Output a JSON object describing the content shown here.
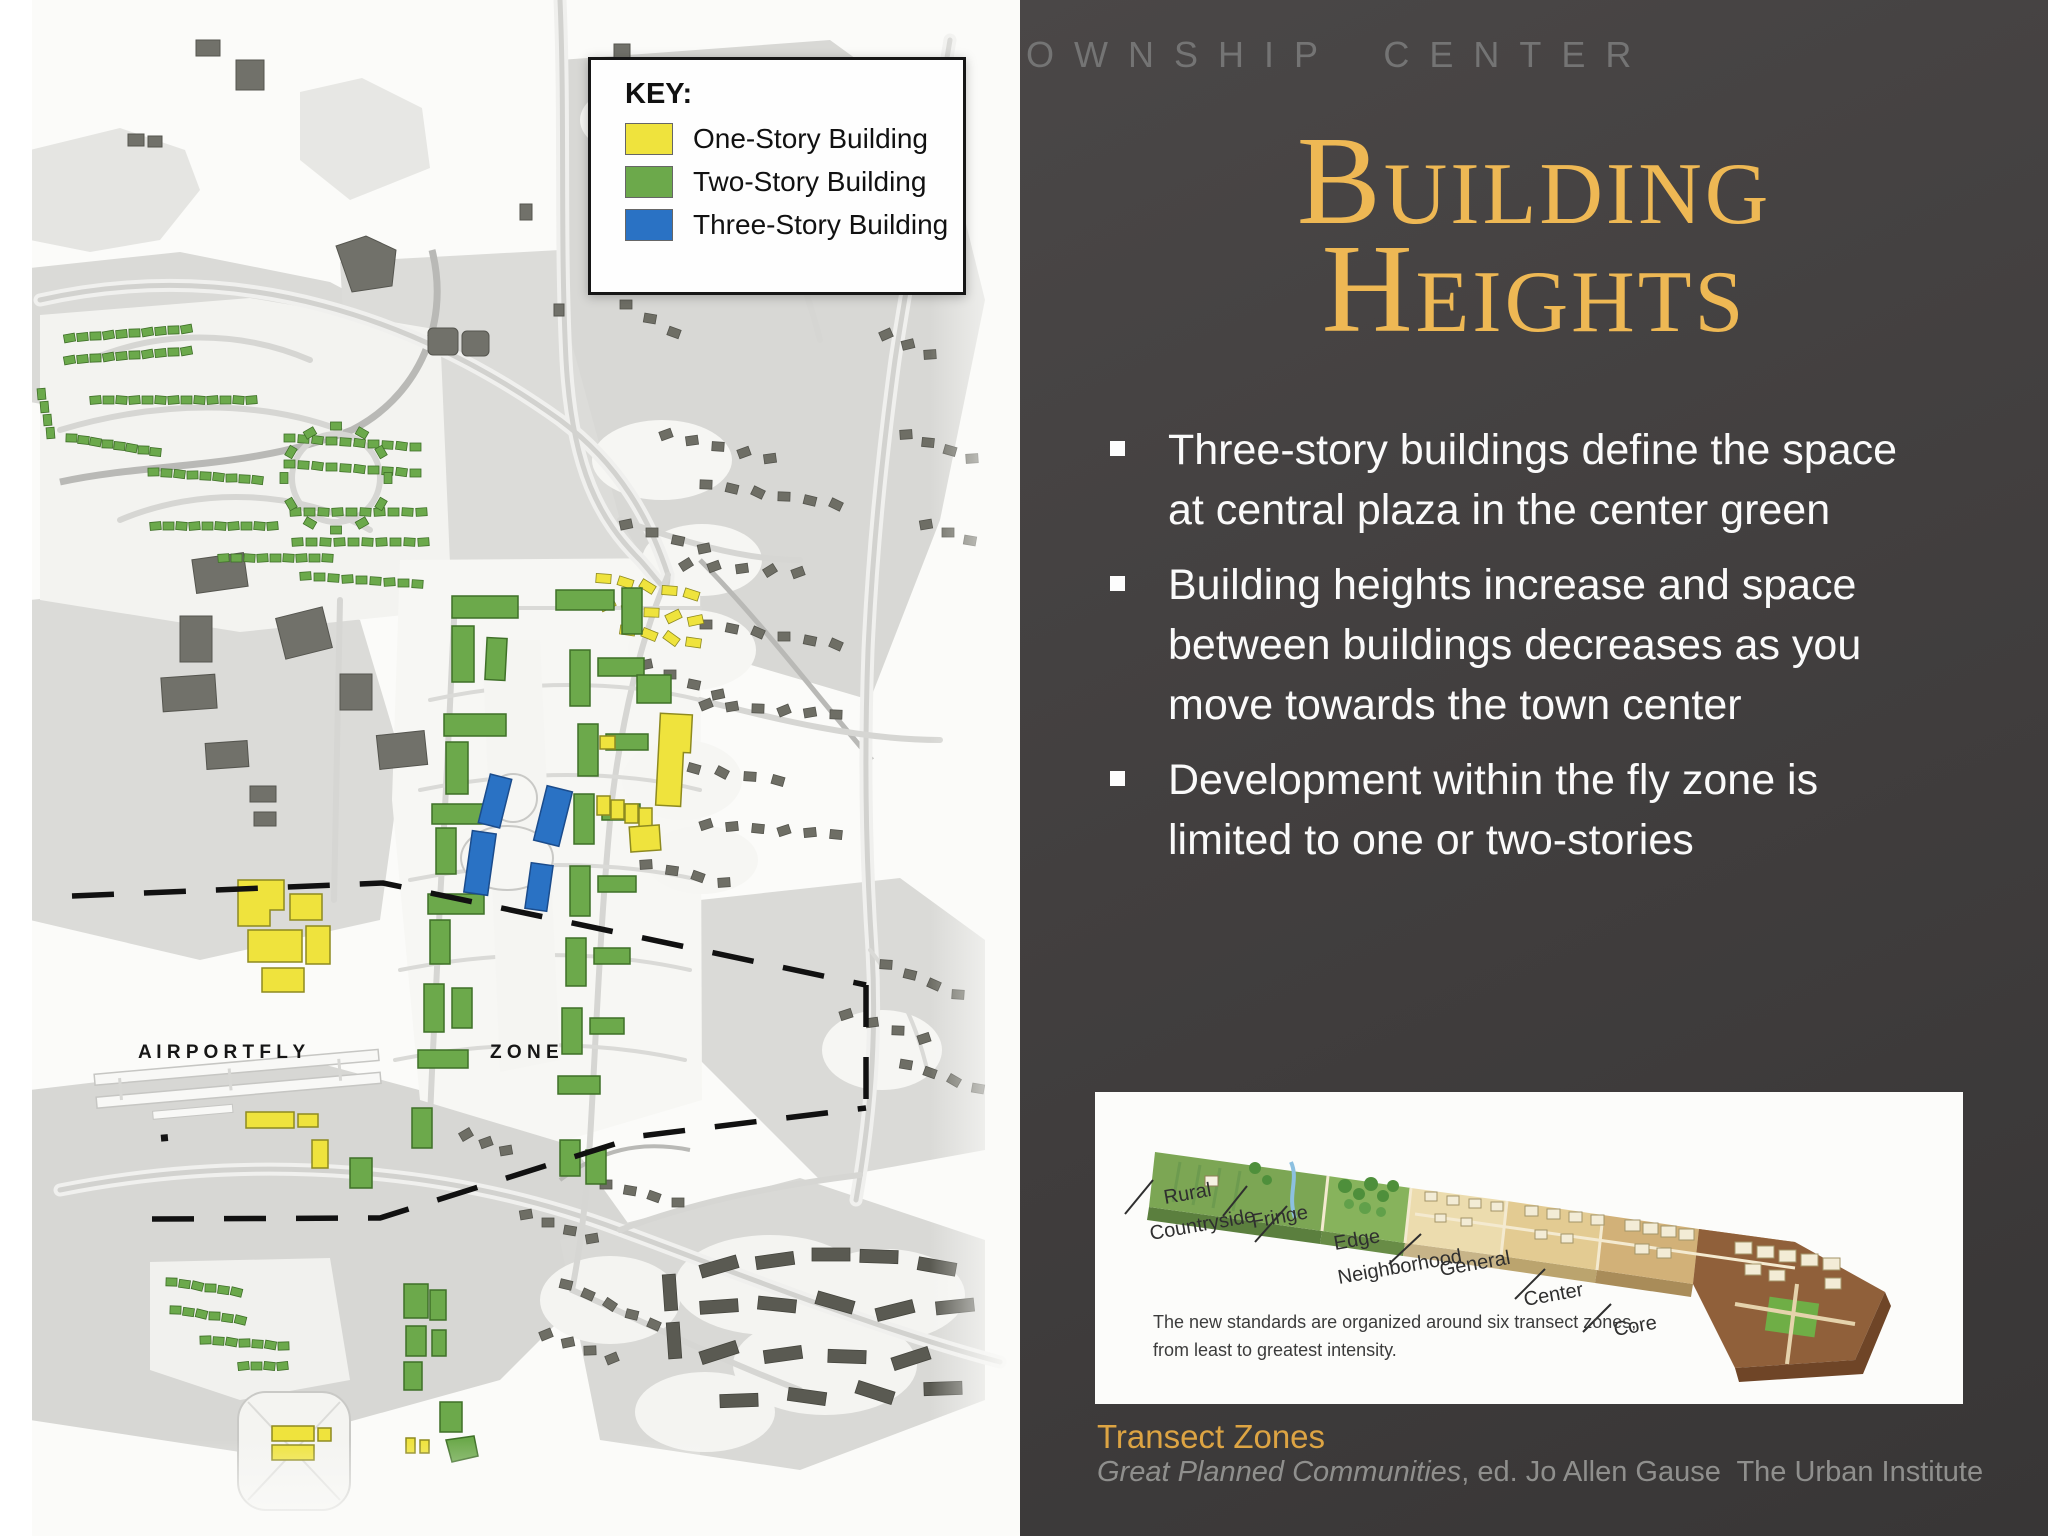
{
  "banner": {
    "text": "OWNSHIP CENTER"
  },
  "title": {
    "line1": "Building",
    "line2": "Heights"
  },
  "bullets": [
    "Three-story buildings define the space at central plaza in the center green",
    "Building heights increase and space between buildings decreases as you move towards the town center",
    "Development within the fly zone is limited to one or two-stories"
  ],
  "map": {
    "key": {
      "title": "KEY:",
      "items": [
        {
          "label": "One-Story Building",
          "color": "#efe33d"
        },
        {
          "label": "Two-Story Building",
          "color": "#6ca94b"
        },
        {
          "label": "Three-Story Building",
          "color": "#2a72c4"
        }
      ]
    },
    "fly_zone_left": "A I R P O R T   F L Y",
    "fly_zone_right": "Z O N E"
  },
  "figure": {
    "zone_labels": {
      "rural": "Rural",
      "countryside": "Countryside",
      "fringe": "Fringe",
      "edge": "Edge",
      "neighborhood": "Neighborhood",
      "general": "General",
      "center": "Center",
      "core": "Core"
    },
    "caption_line1": "The new standards are organized around six transect zones,",
    "caption_line2": "from least to greatest intensity.",
    "title": "Transect Zones",
    "credit_italic": "Great Planned Communities",
    "credit_rest": ", ed. Jo Allen Gause  The Urban Institute"
  },
  "colors": {
    "accent_gold": "#eeb854",
    "panel_bg": "#413e3e",
    "one_story": "#efe33d",
    "two_story": "#6ca94b",
    "three_story": "#2a72c4"
  }
}
